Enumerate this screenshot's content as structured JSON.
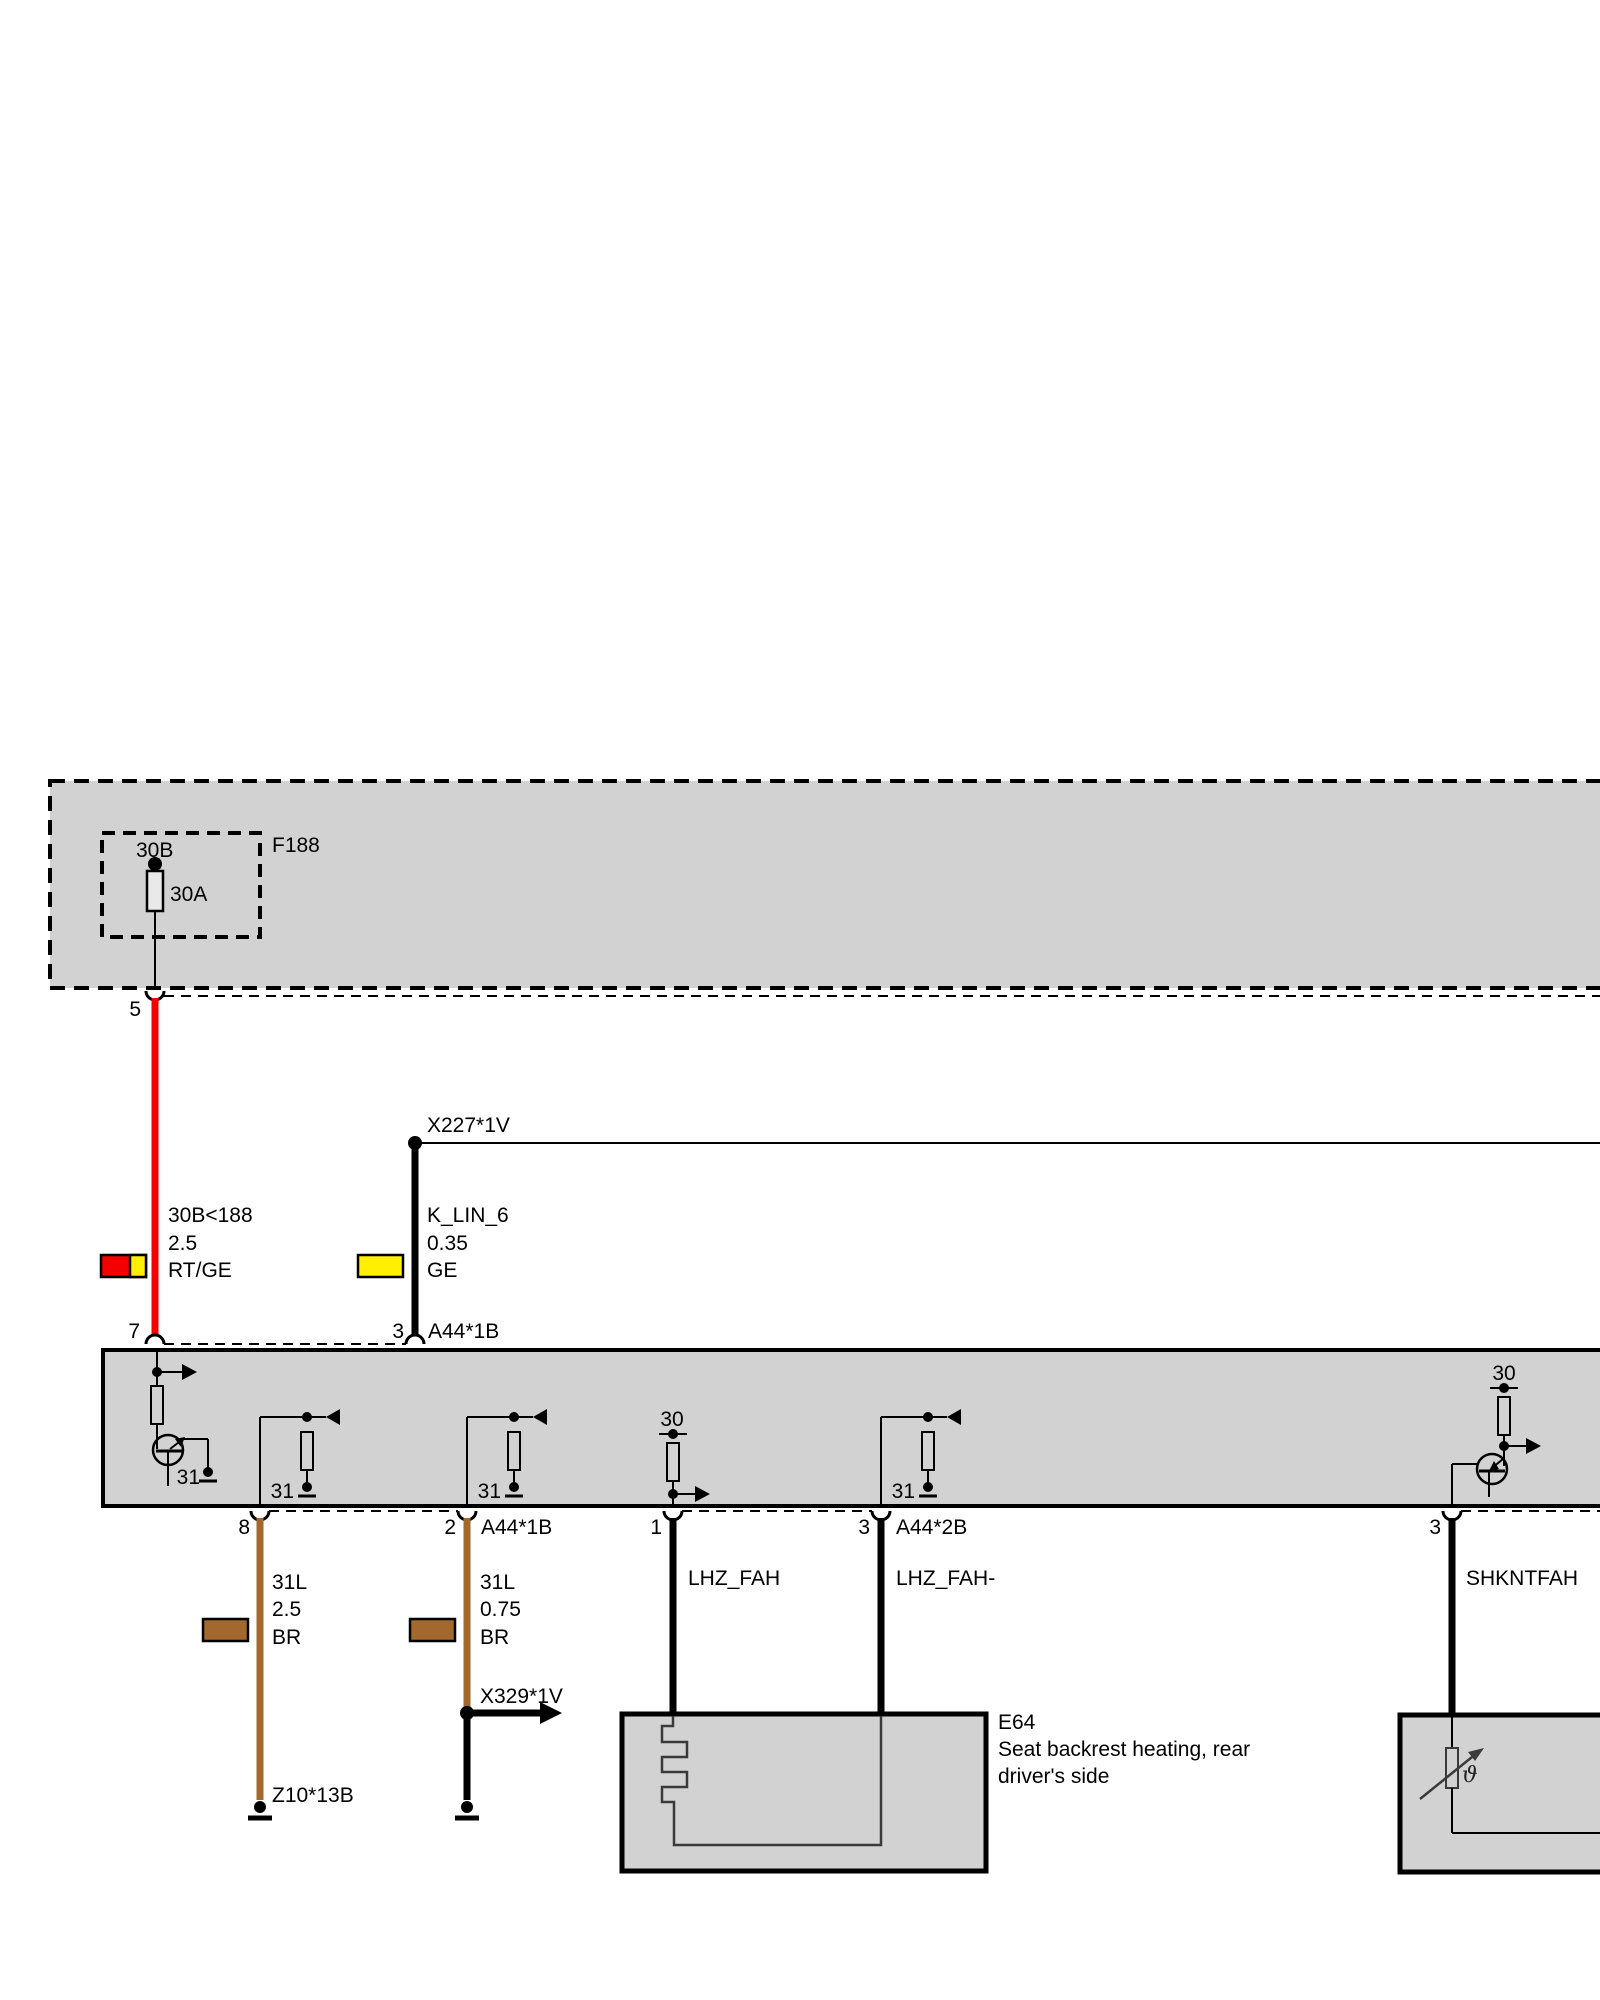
{
  "colors": {
    "red": "#f40000",
    "yellow": "#ffef00",
    "brown": "#a2682c",
    "box_gray": "#d2d2d2"
  },
  "fuse_box": {
    "name": "F188",
    "terminal_top": "30B",
    "rating": "30A",
    "pin": "5"
  },
  "connectors": {
    "x227": "X227*1V",
    "x329": "X329*1V",
    "a44_1b": "A44*1B",
    "a44_2b": "A44*2B",
    "z10": "Z10*13B"
  },
  "wires": {
    "supply": {
      "label": "30B<188",
      "gauge": "2.5",
      "color_code": "RT/GE"
    },
    "k_lin": {
      "label": "K_LIN_6",
      "gauge": "0.35",
      "color_code": "GE"
    },
    "gnd_heavy": {
      "label": "31L",
      "gauge": "2.5",
      "color_code": "BR"
    },
    "gnd_light": {
      "label": "31L",
      "gauge": "0.75",
      "color_code": "BR"
    },
    "lhz_fah": "LHZ_FAH",
    "lhz_fah_minus": "LHZ_FAH-",
    "shkntfah": "SHKNTFAH"
  },
  "module": {
    "pins": {
      "p7": "7",
      "p3_top": "3",
      "p8": "8",
      "p2": "2",
      "p1": "1",
      "p3_a": "3",
      "p3_b": "3"
    },
    "terminal_30": "30",
    "terminal_31": "31"
  },
  "e64": {
    "name": "E64",
    "desc_line1": "Seat backrest heating, rear",
    "desc_line2": "driver's side"
  },
  "symbols": {
    "theta": "ϑ"
  }
}
